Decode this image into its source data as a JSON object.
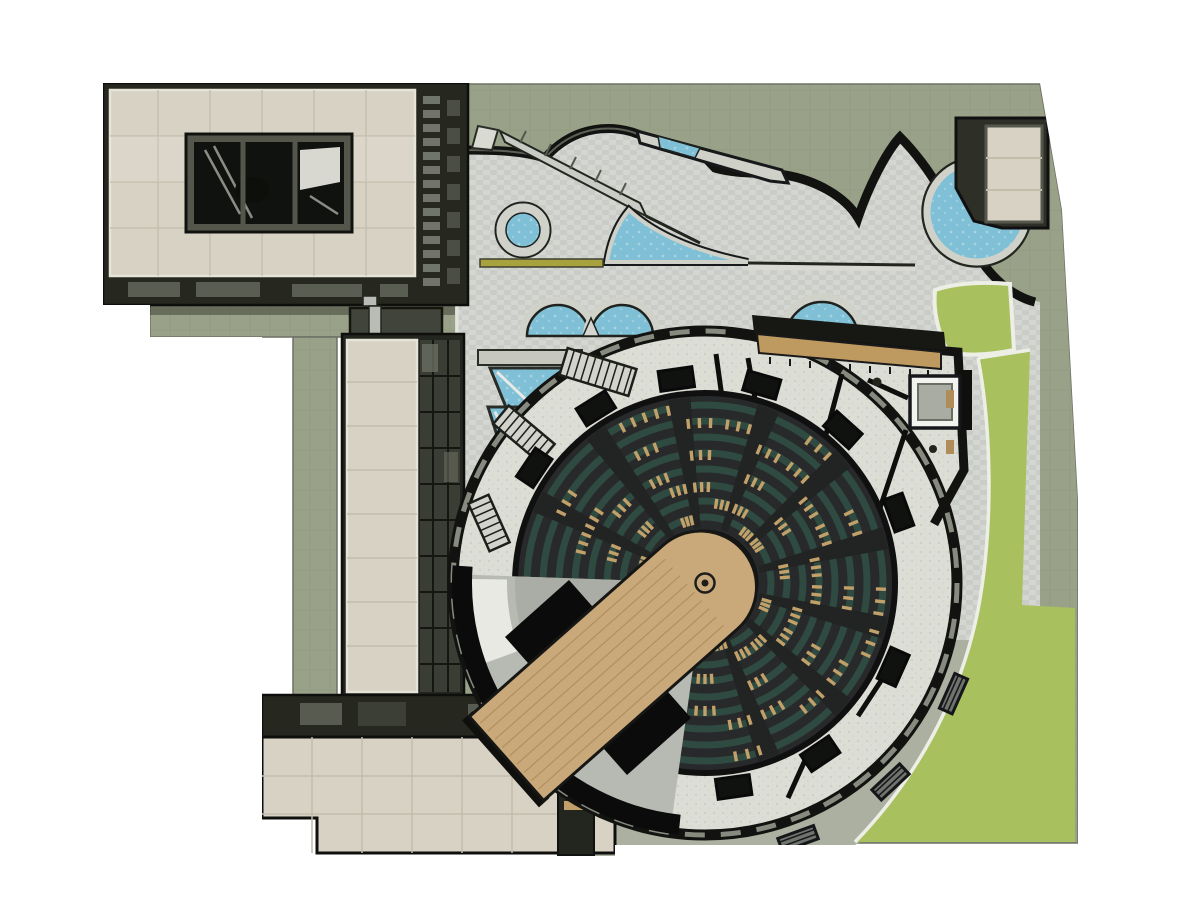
{
  "scene": {
    "type": "architectural-site-plan-rendering",
    "view": "top-down-axonometric",
    "regions": [
      {
        "name": "northwest-gallery-building",
        "desc": "beige tiled roof with dark skylight window"
      },
      {
        "name": "west-tower-building",
        "desc": "tall narrow beige roof with dark glass curtain wall"
      },
      {
        "name": "southwest-building",
        "desc": "beige tiled roof with dark north facade band"
      },
      {
        "name": "entry-tower-northeast",
        "desc": "small dark tower with beige roof beside corner pool"
      },
      {
        "name": "plaza",
        "desc": "light cobblestone court with pools"
      },
      {
        "name": "serpentine-wall",
        "desc": "dark wavy garden wall between plaza and ground"
      },
      {
        "name": "circular-pool",
        "desc": "small round pool"
      },
      {
        "name": "sail-pool",
        "desc": "triangular sail-shaped pool"
      },
      {
        "name": "twin-arc-pools",
        "desc": "two semicircular pools"
      },
      {
        "name": "arc-pool-east",
        "desc": "semicircular pool behind auditorium deck"
      },
      {
        "name": "corner-pool",
        "desc": "round pool clipped by entry tower"
      },
      {
        "name": "glass-skylight-panels",
        "desc": "blue angled glazing along west building"
      },
      {
        "name": "lawn-upper-patch",
        "desc": "small green lawn with white curb"
      },
      {
        "name": "lawn-main",
        "desc": "large green lawn wrapping southeast corner"
      },
      {
        "name": "perimeter-walkway",
        "desc": "gray path ring around auditorium"
      },
      {
        "name": "round-auditorium",
        "desc": "circular theater with concentric seating and lobby ring"
      },
      {
        "name": "thrust-stage",
        "desc": "wooden stadium-shaped stage with runway to southwest"
      },
      {
        "name": "flytower",
        "desc": "black roof band across backstage"
      },
      {
        "name": "wood-deck",
        "desc": "timber entry deck at northeast of auditorium"
      }
    ]
  },
  "palette": {
    "background": "#ffffff",
    "ground_olive": "#99a288",
    "ground_edge": "#6d7164",
    "lawn_green": "#a9c05e",
    "lawn_curb": "#edefe6",
    "path_gray": "#abb0a0",
    "plaza_paving": "#d4d6d1",
    "plaza_texture": "#bcc0ba",
    "lobby_paving": "#dcded6",
    "water_blue": "#7fc0d6",
    "water_light": "#aad8e4",
    "pool_frame": "#d0d2ca",
    "wall_black": "#121310",
    "facade_dark": "#26281f",
    "facade_glass": "#3a3d33",
    "window_gray": "#71746a",
    "window_dark": "#4b4e44",
    "roof_beige": "#d7d2c3",
    "roof_tile_line": "#c2bcab",
    "roof_curb": "#e6e3d8",
    "seating_charcoal": "#27292a",
    "seating_aisle": "#212423",
    "seating_teal": "#2f4a40",
    "seat_wood": "#c2a06a",
    "stage_wood": "#c9a87a",
    "stage_wood_line": "#b18f5e",
    "deck_wood": "#bf9a60",
    "flytower_black": "#0b0b0b",
    "wedge_gray": "#b7bab2",
    "wedge_gray_dark": "#a9ada5",
    "wedge_white": "#e8e9e3",
    "bench_gray": "#6f736c",
    "accent_yellow": "#a8a23e",
    "rim_panel": "#868a7f"
  },
  "auditorium": {
    "center": [
      705,
      583
    ],
    "outer_r": 252,
    "walk_r": 302,
    "bowl_r": 190,
    "pit_r": 52,
    "ring_radii": [
      66,
      82,
      98,
      114,
      130,
      146,
      162,
      178
    ],
    "tick_radii": [
      64,
      80,
      96,
      112,
      128,
      144,
      160,
      176
    ],
    "aisle_angles": [
      206,
      234,
      262,
      290,
      318,
      346,
      14,
      42,
      70
    ],
    "tick_angles": [
      198,
      210,
      222,
      246,
      254,
      268,
      282,
      296,
      310,
      324,
      338,
      352,
      6,
      20,
      34,
      48,
      62,
      76,
      90
    ],
    "vestibule_angles": [
      214,
      238,
      262,
      286,
      312,
      340,
      24,
      56,
      82
    ],
    "bench_angles": [
      24,
      47,
      70
    ],
    "backstage_sector": [
      98,
      182
    ],
    "stage_angle_deg": 138.5,
    "stage_length": 265,
    "stage_half_width": 56,
    "stair_runs": [
      [
        598,
        372,
        17,
        72,
        28
      ],
      [
        524,
        434,
        40,
        60,
        24
      ],
      [
        489,
        523,
        66,
        52,
        22
      ]
    ]
  }
}
